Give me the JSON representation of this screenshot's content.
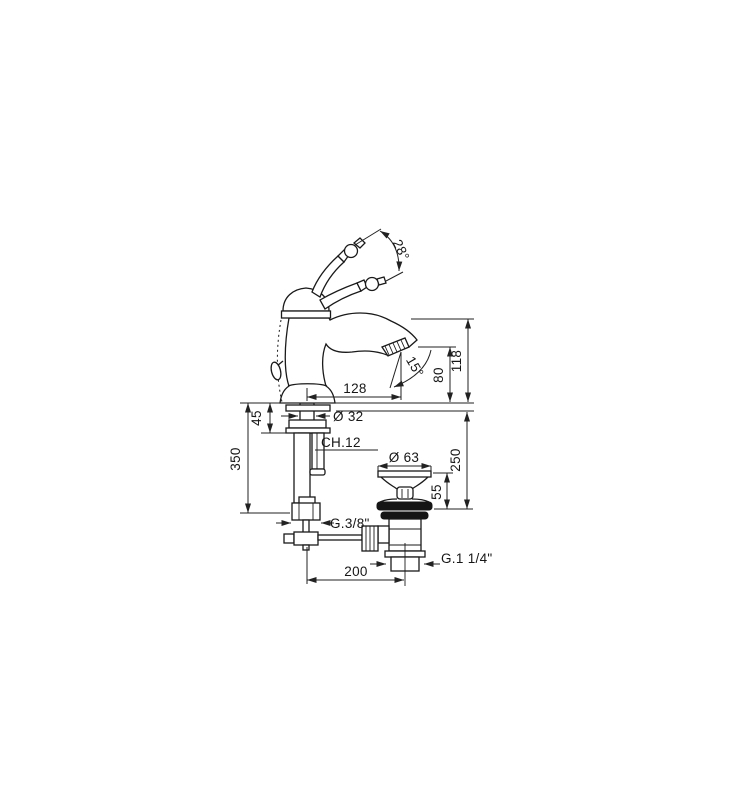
{
  "page": {
    "background": "#ffffff",
    "line_color": "#1a1a1a"
  },
  "drawing": {
    "labels": {
      "handle_angle": "28°",
      "spout_angle": "15°",
      "spout_reach": "128",
      "outlet_height": "80",
      "overall_height": "118",
      "deck_clamp": "45",
      "shank_diameter": "Ø 32",
      "wrench_size": "CH.12",
      "hose_drop": "350",
      "waste_cap_diameter": "Ø 63",
      "waste_cap_height": "55",
      "waste_drop": "250",
      "hose_thread": "G.3/8\"",
      "rod_offset": "200",
      "waste_thread": "G.1 1/4\""
    }
  }
}
